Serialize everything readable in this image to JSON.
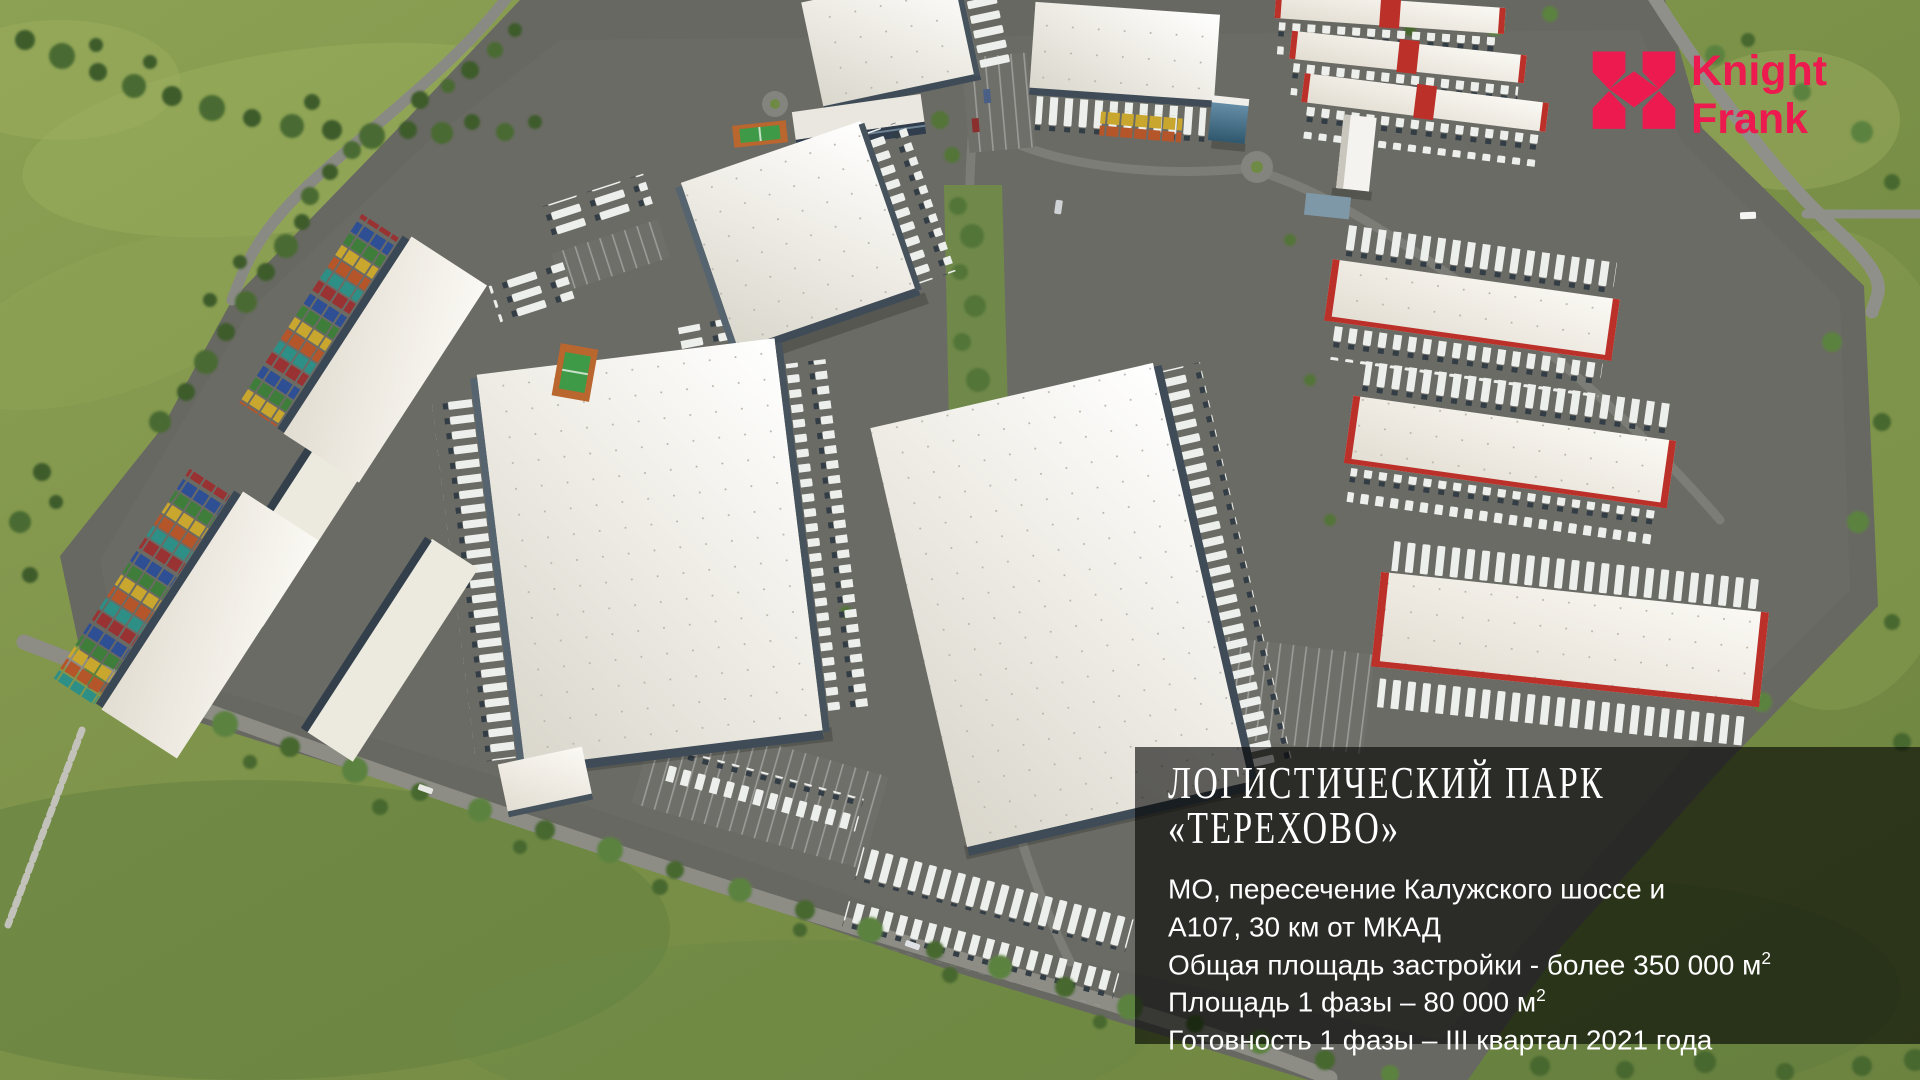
{
  "logo": {
    "line1": "Knight",
    "line2": "Frank",
    "color": "#ED1A50"
  },
  "overlay": {
    "title_line1": "ЛОГИСТИЧЕСКИЙ ПАРК",
    "title_line2": "«ТЕРЕХОВО»",
    "info_lines": [
      {
        "text": "МО, пересечение Калужского шоссе и"
      },
      {
        "text": "А107, 30 км от МКАД"
      },
      {
        "text": "Общая площадь застройки - более 350 000 м",
        "sup": "2"
      },
      {
        "text": "Площадь 1 фазы – 80 000 м",
        "sup": "2"
      },
      {
        "text": "Готовность 1 фазы – III квартал 2021 года"
      }
    ]
  },
  "scene": {
    "palette": {
      "grass": "#7F934C",
      "asphalt": "#686862",
      "roof_white": "#EFEDE6",
      "accent_red": "#BB3029",
      "container_blue": "#2E4F93",
      "container_green": "#3F7D3A",
      "container_yellow": "#C9A62E",
      "court_orange": "#B9662F",
      "court_green": "#3F9A47"
    }
  }
}
